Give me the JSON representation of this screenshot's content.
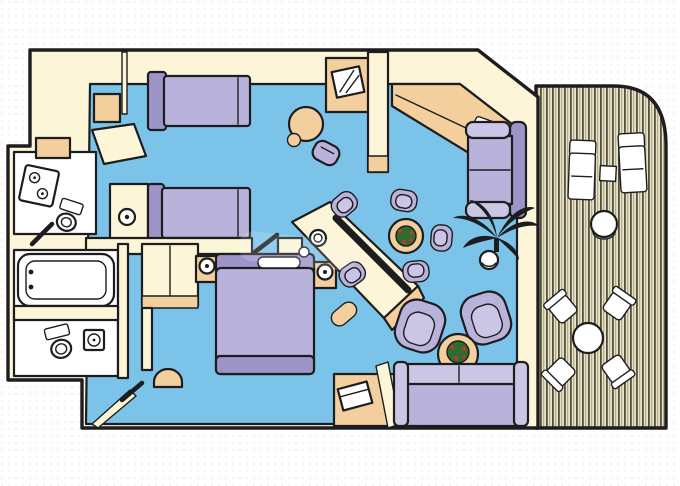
{
  "title": "Two-bedroom suite floor plan with private balcony",
  "palette": {
    "bg": "#ffffff",
    "dot": "#e8dede",
    "ink": "#1d1d1f",
    "wall": "#fcf5d8",
    "tan": "#f2cf9d",
    "tanDark": "#e3b87d",
    "floor": "#7cc3e9",
    "lav": "#b9b3db",
    "lavLight": "#cbc6e6",
    "lavDark": "#9d95c8",
    "white": "#ffffff",
    "deckBase": "#e9e3c9",
    "deckStripe": "#55513d",
    "deckMid": "#a29e80",
    "plantGreen": "#2f6b2f",
    "plantRed": "#c0392b"
  },
  "legend": {
    "rooms": [
      "second-bedroom",
      "upper-bathroom",
      "lower-bathroom",
      "master-bedroom",
      "living-dining-room",
      "balcony"
    ],
    "furniture": [
      "twin-bed",
      "queen-bed",
      "vanity-desk",
      "round-table",
      "stool",
      "tv-cabinet",
      "wardrobe",
      "bathtub",
      "toilet",
      "sink",
      "wet-bar",
      "dining-table",
      "dining-chair",
      "armchair",
      "coffee-table",
      "loveseat",
      "palm-plant",
      "sofa",
      "lamp",
      "sun-lounger",
      "deck-table",
      "deck-chair"
    ]
  }
}
